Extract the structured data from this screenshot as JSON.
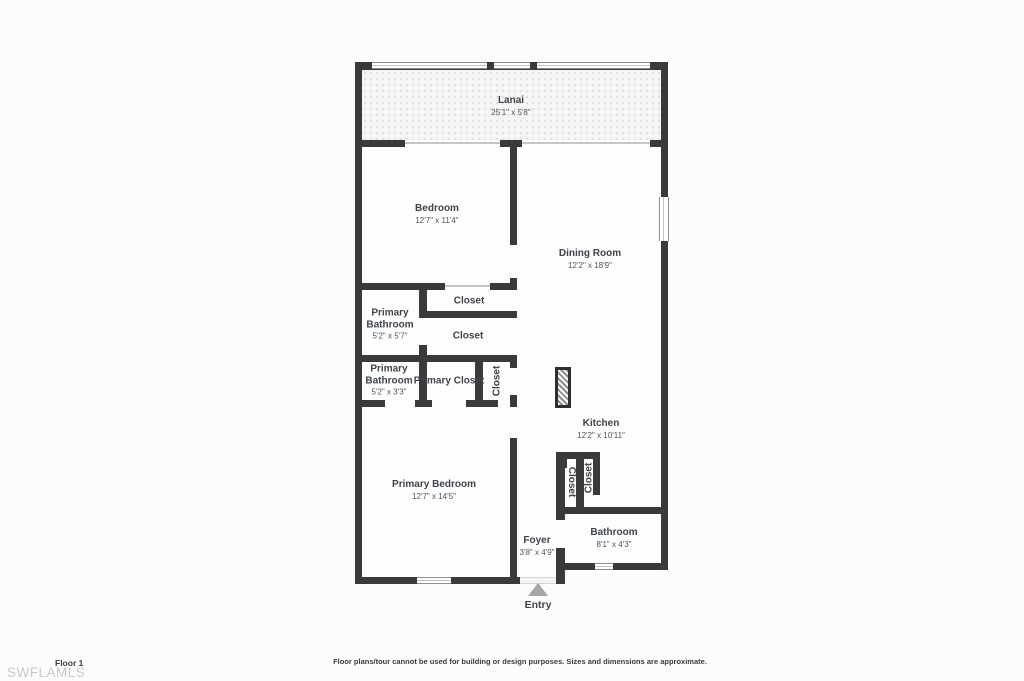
{
  "meta": {
    "floor_label": "Floor 1",
    "watermark": "SWFLAMLS",
    "entry_label": "Entry",
    "disclaimer": "Floor plans/tour cannot be used for building or design purposes. Sizes and dimensions are approximate."
  },
  "colors": {
    "wall": "#3a3a3a",
    "room": "#fdfdfd",
    "text": "#3f444a",
    "dims": "#4e545b",
    "arrow": "#a6a6a6",
    "watermark": "#c9c9c9"
  },
  "rooms": {
    "lanai": {
      "name": "Lanai",
      "dims": "25'1\" x 5'8\""
    },
    "bedroom": {
      "name": "Bedroom",
      "dims": "12'7\" x 11'4\""
    },
    "dining_room": {
      "name": "Dining Room",
      "dims": "12'2\" x 18'9\""
    },
    "closet_upper": {
      "name": "Closet"
    },
    "closet_lower": {
      "name": "Closet"
    },
    "primary_bathroom_1": {
      "name": "Primary Bathroom",
      "dims": "5'2\" x 5'7\""
    },
    "primary_bathroom_2": {
      "name": "Primary Bathroom",
      "dims": "5'2\" x 3'3\""
    },
    "primary_closet": {
      "name": "Primary Closet"
    },
    "closet_mid_vertical": {
      "name": "Closet"
    },
    "kitchen": {
      "name": "Kitchen",
      "dims": "12'2\" x 10'11\""
    },
    "closet_kitchen_left": {
      "name": "Closet"
    },
    "closet_kitchen_right": {
      "name": "Closet"
    },
    "primary_bedroom": {
      "name": "Primary Bedroom",
      "dims": "12'7\" x 14'5\""
    },
    "foyer": {
      "name": "Foyer",
      "dims": "3'8\" x 4'9\""
    },
    "bathroom": {
      "name": "Bathroom",
      "dims": "8'1\" x 4'3\""
    }
  }
}
